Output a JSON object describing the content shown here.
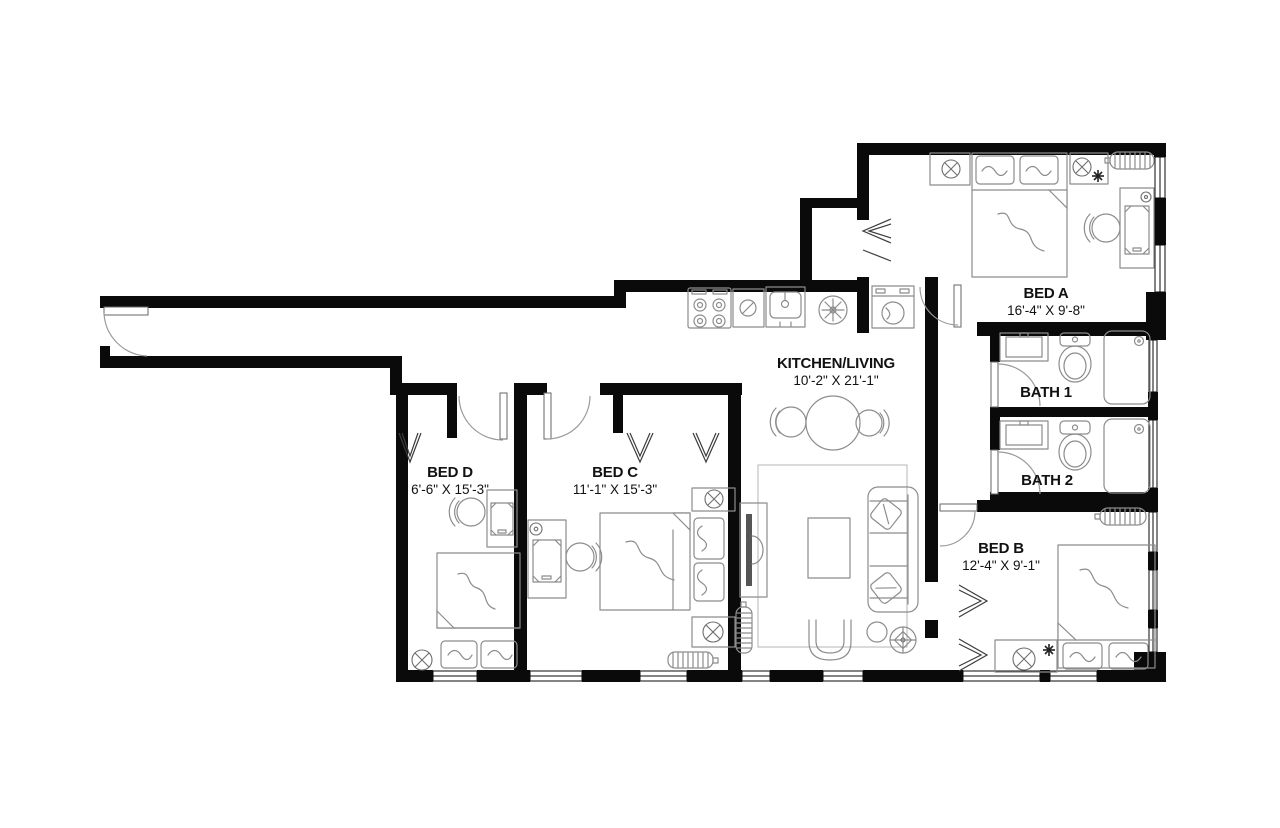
{
  "colors": {
    "background": "#ffffff",
    "wall": "#0a0a0a",
    "furniture": "#8c8c8c",
    "door_arc": "#9a9a9a",
    "text": "#111111"
  },
  "rooms": {
    "bed_a": {
      "label": "BED A",
      "dimensions": "16'-4\" X 9'-8\""
    },
    "kitchen_living": {
      "label": "KITCHEN/LIVING",
      "dimensions": "10'-2\" X 21'-1\""
    },
    "bath_1": {
      "label": "BATH 1"
    },
    "bath_2": {
      "label": "BATH 2"
    },
    "bed_b": {
      "label": "BED B",
      "dimensions": "12'-4\" X 9'-1\""
    },
    "bed_c": {
      "label": "BED C",
      "dimensions": "11'-1\" X 15'-3\""
    },
    "bed_d": {
      "label": "BED D",
      "dimensions": "6'-6\" X 15'-3\""
    }
  },
  "furniture_symbols": [
    "double-bed",
    "pillow",
    "nightstand",
    "table-lamp",
    "desk",
    "desk-chair",
    "radiator",
    "bifold-closet-door",
    "door-swing",
    "window",
    "range-stove",
    "dishwasher",
    "kitchen-sink",
    "ceiling-fan",
    "stacked-washer-dryer",
    "dining-table",
    "dining-chair",
    "area-rug",
    "coffee-table",
    "sofa",
    "throw-pillow",
    "tv-console",
    "armchair",
    "side-table",
    "potted-plant",
    "bathroom-vanity",
    "toilet",
    "shower"
  ]
}
